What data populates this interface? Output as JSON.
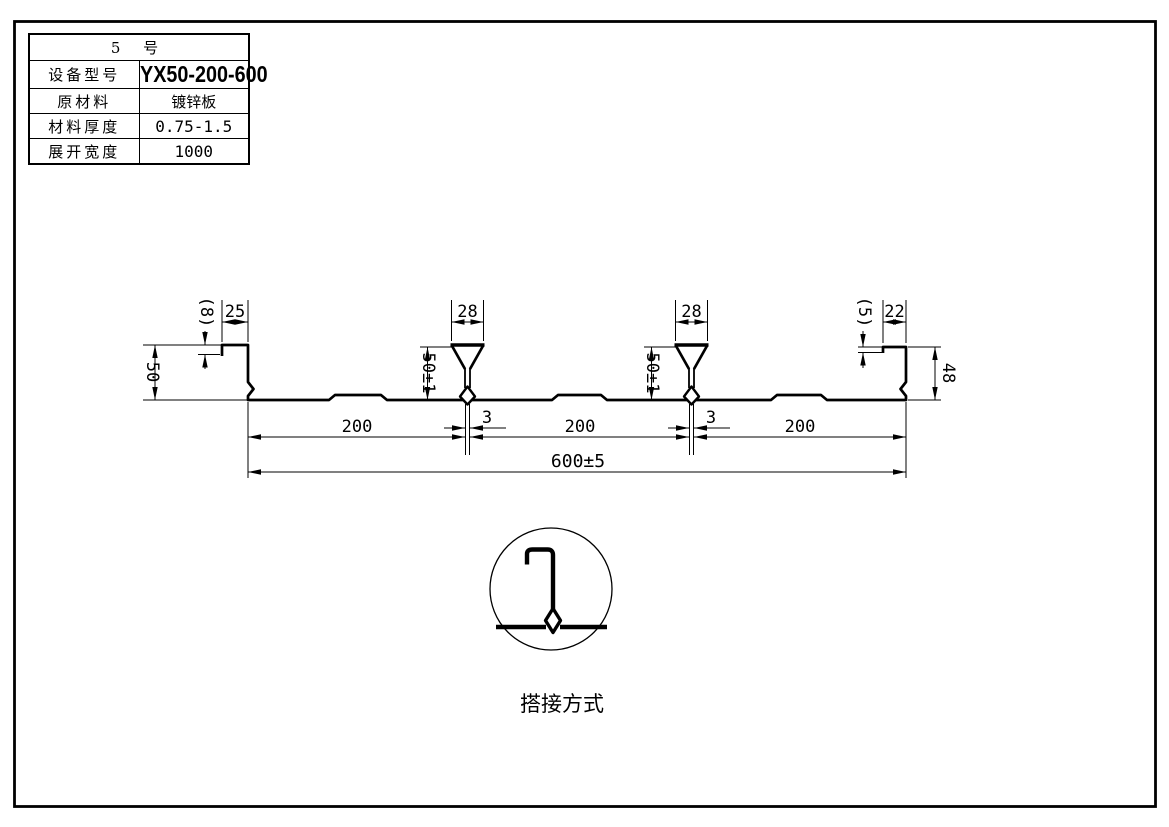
{
  "table": {
    "machine_no": "5 号",
    "rows": [
      {
        "label": "设备型号",
        "value": "YX50-200-600"
      },
      {
        "label": "原材料",
        "value": "镀锌板"
      },
      {
        "label": "材料厚度",
        "value": "0.75-1.5"
      },
      {
        "label": "展开宽度",
        "value": "1000"
      }
    ]
  },
  "drawing": {
    "dimensions": {
      "left_edge_lip": "(8)",
      "left_edge_top_width": "25",
      "left_edge_height": "50",
      "rib_top_width": "28",
      "rib_height": "50±1",
      "rib_seam_width": "3",
      "span_width": "200",
      "total_width": "600±5",
      "right_edge_lip": "(5)",
      "right_edge_top_width": "22",
      "right_edge_height": "48"
    },
    "detail_label": "搭接方式"
  },
  "colors": {
    "line": "#000000",
    "background": "#ffffff"
  }
}
